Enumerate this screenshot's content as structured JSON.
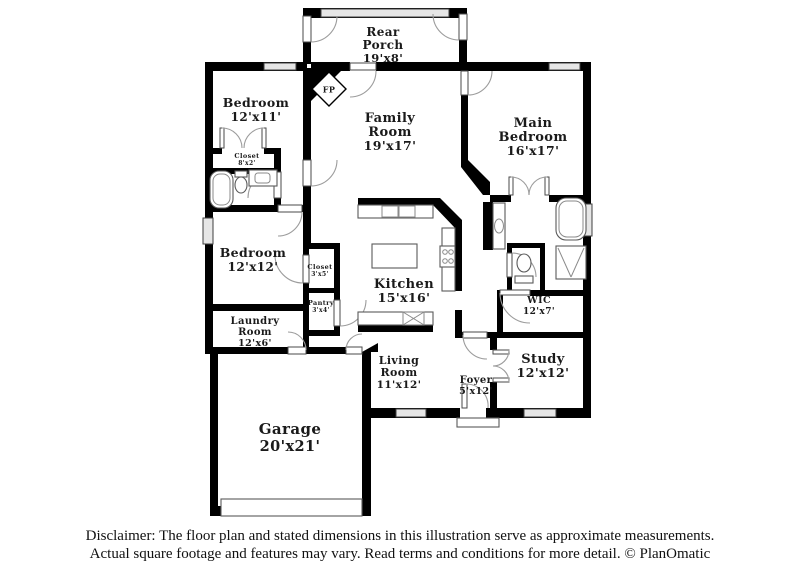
{
  "colors": {
    "wall": "#000000",
    "window_fill": "#e6e6e6",
    "door_arc": "#9c9c9c",
    "text": "#1a1a1a",
    "background": "#ffffff"
  },
  "rooms": {
    "rear_porch": {
      "lines": [
        "Rear",
        "Porch",
        "19'x8'"
      ]
    },
    "bedroom1": {
      "lines": [
        "Bedroom",
        "12'x11'"
      ]
    },
    "family_room": {
      "lines": [
        "Family",
        "Room",
        "19'x17'"
      ]
    },
    "main_bedroom": {
      "lines": [
        "Main",
        "Bedroom",
        "16'x17'"
      ]
    },
    "bedroom2": {
      "lines": [
        "Bedroom",
        "12'x12'"
      ]
    },
    "closet1": {
      "lines": [
        "Closet",
        "8'x2'"
      ]
    },
    "closet2": {
      "lines": [
        "Closet",
        "3'x5'"
      ]
    },
    "pantry": {
      "lines": [
        "Pantry",
        "3'x4'"
      ]
    },
    "laundry": {
      "lines": [
        "Laundry",
        "Room",
        "12'x6'"
      ]
    },
    "kitchen": {
      "lines": [
        "Kitchen",
        "15'x16'"
      ]
    },
    "wic": {
      "lines": [
        "WIC",
        "12'x7'"
      ]
    },
    "living_room": {
      "lines": [
        "Living",
        "Room",
        "11'x12'"
      ]
    },
    "foyer": {
      "lines": [
        "Foyer",
        "5'x12'"
      ]
    },
    "study": {
      "lines": [
        "Study",
        "12'x12'"
      ]
    },
    "garage": {
      "lines": [
        "Garage",
        "20'x21'"
      ]
    },
    "fireplace": {
      "lines": [
        "FP"
      ]
    }
  },
  "disclaimer": {
    "line1": "Disclaimer: The floor plan and stated dimensions in this illustration serve as approximate measurements.",
    "line2": "Actual square footage and features may vary. Read terms and conditions for more detail. © PlanOmatic"
  }
}
